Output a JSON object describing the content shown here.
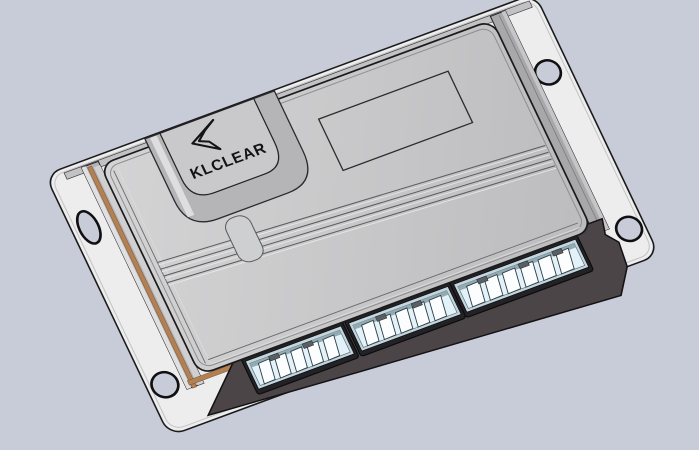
{
  "scene": {
    "object": "ecu-controller-3d-render",
    "view": "isometric",
    "logo_text": "KLCLEAR"
  },
  "colors": {
    "background": "#c8ccd8",
    "plate": "#ededee",
    "lid_light": "#d4d4d5",
    "lid_dark": "#bcbcbe",
    "side_wall": "#b3b3b5",
    "gasket": "#b28052",
    "case_dark": "#4b4547",
    "connector_recess": "#232327",
    "connector_rim": "#c3d5dd",
    "connector_face": "#e3f1f8",
    "pin": "#fbfdfe",
    "edge": "#1b1b1b"
  },
  "connectors": {
    "count": 3,
    "pin_blades": [
      5,
      5,
      6
    ]
  },
  "mount_holes": {
    "count": 4,
    "shapes": [
      "slot",
      "round",
      "round",
      "round"
    ]
  }
}
